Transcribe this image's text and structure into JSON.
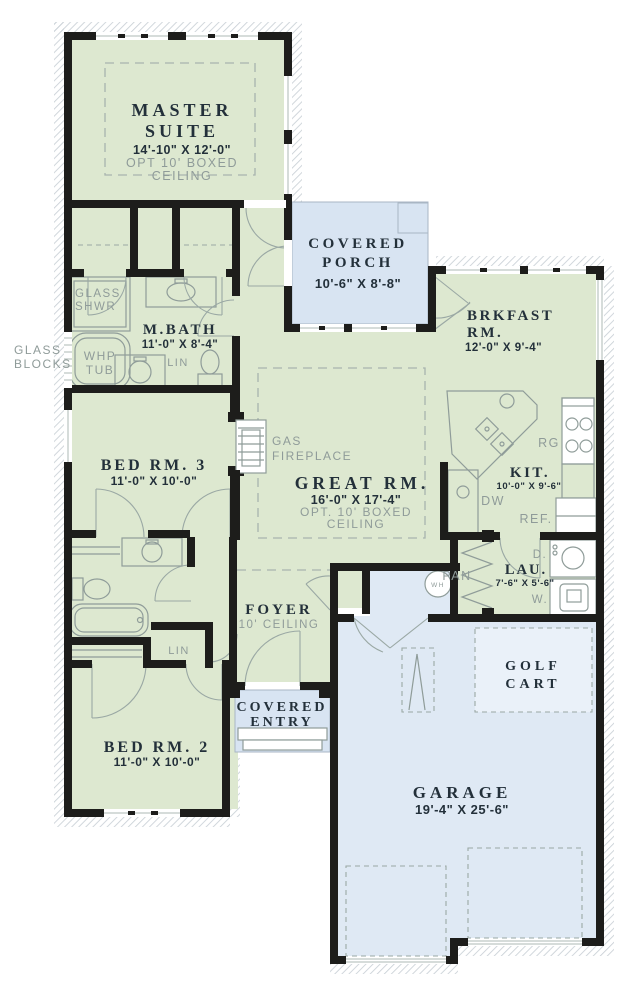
{
  "colors": {
    "room_green": "#dde8d0",
    "porch_blue": "#d8e4f2",
    "garage_blue": "#dfe9f4",
    "golf_blue": "#eaf1f9",
    "wall": "#1d1d1b",
    "ink": "#23303a",
    "muted": "#8f9b99"
  },
  "rooms": {
    "master_suite": {
      "line1": "MASTER",
      "line2": "SUITE",
      "dims": "14'-10\" X 12'-0\"",
      "note1": "OPT 10' BOXED",
      "note2": "CEILING"
    },
    "covered_porch": {
      "line1": "COVERED",
      "line2": "PORCH",
      "dims": "10'-6\" X 8'-8\""
    },
    "brkfast": {
      "line1": "BRKFAST",
      "line2": "RM.",
      "dims": "12'-0\" X 9'-4\""
    },
    "mbath": {
      "name": "M.BATH",
      "dims": "11'-0\" X 8'-4\""
    },
    "bed3": {
      "name": "BED RM. 3",
      "dims": "11'-0\" X 10'-0\""
    },
    "great": {
      "name": "GREAT RM.",
      "dims": "16'-0\" X 17'-4\"",
      "note1": "OPT. 10' BOXED",
      "note2": "CEILING"
    },
    "kitchen": {
      "name": "KIT.",
      "dims": "10'-0\" X 9'-6\""
    },
    "laundry": {
      "name": "LAU.",
      "dims": "7'-6\" X 5'-6\""
    },
    "foyer": {
      "name": "FOYER",
      "note": "10' CEILING"
    },
    "covered_entry": {
      "line1": "COVERED",
      "line2": "ENTRY"
    },
    "bed2": {
      "name": "BED RM. 2",
      "dims": "11'-0\" X 10'-0\""
    },
    "golf_cart": {
      "line1": "GOLF",
      "line2": "CART"
    },
    "garage": {
      "name": "GARAGE",
      "dims": "19'-4\" X 25'-6\""
    }
  },
  "labels": {
    "glass_blocks1": "GLASS",
    "glass_blocks2": "BLOCKS",
    "glass_shwr1": "GLASS",
    "glass_shwr2": "SHWR",
    "whp_tub1": "WHP",
    "whp_tub2": "TUB",
    "gas_fireplace1": "GAS",
    "gas_fireplace2": "FIREPLACE",
    "lin_bath": "LIN",
    "lin_hall": "LIN",
    "range": "RG",
    "dishwasher": "DW",
    "refrigerator": "REF.",
    "pantry": "PAN",
    "dryer": "D.",
    "washer": "W.",
    "water_heater": "WH"
  }
}
